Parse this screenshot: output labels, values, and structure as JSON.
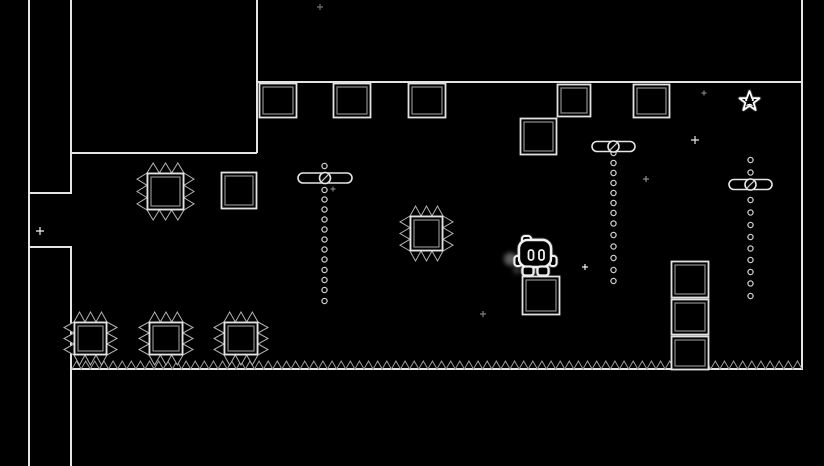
{
  "scene": {
    "width": 824,
    "height": 466,
    "bg_color": "#000000",
    "wall_color": "#e4e4e4",
    "crate_outline_color": "#e2e2e2",
    "crate_inner_color": "#8f8f8f",
    "spike_color": "#b2b2b2",
    "floor_spike_color": "#9a9a9a",
    "chain_color": "#c9c9c9",
    "spinner_color": "#e6e6e6",
    "star_color": "#ffffff",
    "player_color": "#f0f0f0",
    "sparkle_color": "#ffffff"
  },
  "level": {
    "walls": [
      [
        29,
        0,
        29,
        466
      ],
      [
        71,
        0,
        71,
        193
      ],
      [
        71,
        247,
        71,
        466
      ],
      [
        29,
        193,
        72,
        193
      ],
      [
        29,
        247,
        72,
        247
      ],
      [
        257,
        0,
        257,
        153
      ],
      [
        71,
        153,
        257,
        153
      ],
      [
        257,
        82,
        803,
        82
      ],
      [
        802,
        0,
        802,
        370
      ],
      [
        71,
        369,
        803,
        369
      ]
    ],
    "crates": [
      [
        259,
        83,
        38,
        35
      ],
      [
        333,
        83,
        38,
        35
      ],
      [
        408,
        83,
        38,
        35
      ],
      [
        557,
        84,
        34,
        33
      ],
      [
        633,
        84,
        37,
        34
      ],
      [
        520,
        118,
        37,
        37
      ],
      [
        221,
        172,
        36,
        37
      ],
      [
        522,
        276,
        38,
        39
      ],
      [
        671,
        261,
        38,
        37
      ],
      [
        671,
        299,
        38,
        36
      ],
      [
        671,
        336,
        38,
        34
      ]
    ],
    "spiked_blocks": [
      {
        "x": 147,
        "y": 173,
        "w": 37,
        "h": 37,
        "spike": 10
      },
      {
        "x": 410,
        "y": 216,
        "w": 33,
        "h": 35,
        "spike": 10
      },
      {
        "x": 74,
        "y": 322,
        "w": 33,
        "h": 33,
        "spike": 10
      },
      {
        "x": 149,
        "y": 322,
        "w": 34,
        "h": 33,
        "spike": 10
      },
      {
        "x": 224,
        "y": 322,
        "w": 34,
        "h": 33,
        "spike": 10
      }
    ],
    "floor_spikes": {
      "x1": 72,
      "x2": 802,
      "y": 369,
      "height": 8,
      "period": 9.125
    },
    "chain_spinners": [
      {
        "x": 324.5,
        "hub_x": 325,
        "hub_y": 178,
        "span": 54,
        "dots": [
          166,
          190,
          199.5,
          209.5,
          219.5,
          229.5,
          239.5,
          249.5,
          259.5,
          270,
          280,
          290,
          301
        ]
      },
      {
        "x": 613.5,
        "hub_x": 613.5,
        "hub_y": 146.5,
        "span": 43,
        "dots": [
          153,
          163,
          173,
          183,
          193,
          203,
          213,
          223.5,
          235,
          246.5,
          258,
          270,
          281
        ]
      },
      {
        "x": 750.5,
        "hub_x": 750.5,
        "hub_y": 184.5,
        "span": 43,
        "dots": [
          160,
          172.5,
          200,
          212.5,
          225,
          237,
          248.5,
          260,
          272,
          283.5,
          296
        ]
      }
    ],
    "star": {
      "cx": 749.5,
      "cy": 101.5,
      "outer_r": 10.5,
      "inner_r": 4.2
    },
    "player": {
      "x": 519,
      "y": 240,
      "facing": "right",
      "dust": true
    },
    "sparkles": [
      {
        "x": 40,
        "y": 231,
        "arm": 4,
        "opacity": 0.95
      },
      {
        "x": 320,
        "y": 7,
        "arm": 3,
        "opacity": 0.45
      },
      {
        "x": 333,
        "y": 189,
        "arm": 2.5,
        "opacity": 0.5
      },
      {
        "x": 695,
        "y": 140,
        "arm": 4,
        "opacity": 0.9
      },
      {
        "x": 704,
        "y": 93,
        "arm": 2.5,
        "opacity": 0.5
      },
      {
        "x": 646,
        "y": 179,
        "arm": 3,
        "opacity": 0.55
      },
      {
        "x": 585,
        "y": 267,
        "arm": 3,
        "opacity": 0.95
      },
      {
        "x": 483,
        "y": 314,
        "arm": 3,
        "opacity": 0.5
      }
    ]
  }
}
